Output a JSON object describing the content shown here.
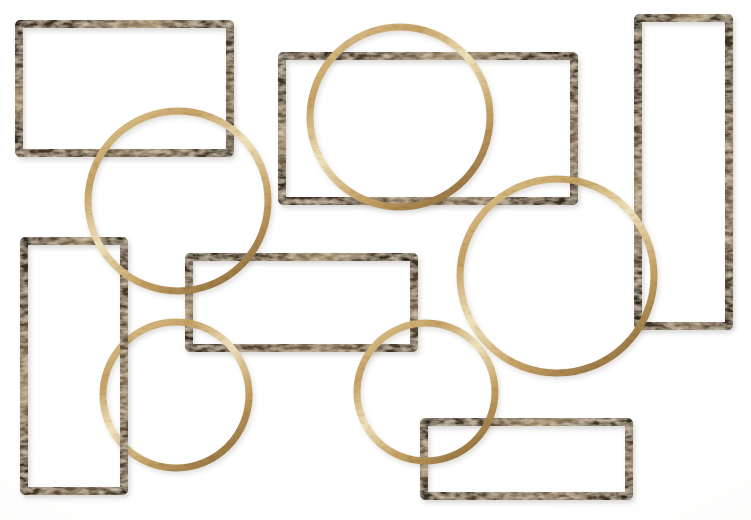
{
  "meta": {
    "description": "Decorative metal wall art: interlocking distressed bronze open rectangles and antique gold rings on a white background"
  },
  "artwork": {
    "canvas": {
      "width": 751,
      "height": 520
    },
    "background": "#ffffff",
    "materials": {
      "bronze": {
        "base": "#4e3d2b",
        "dark": "#2e241a",
        "light": "#7b654a",
        "highlight": "#9c8766",
        "speckle": "#b39973"
      },
      "gold": {
        "base": "#c4a165",
        "dark": "#9a7945",
        "light": "#e4cf9d",
        "highlight": "#f0e2bc",
        "speckle": "#8a6c3b"
      }
    },
    "shadow": {
      "dx": 2,
      "dy": 3,
      "blur": 2.5,
      "color": "#555044",
      "opacity": 0.22
    },
    "shapes": [
      {
        "id": "rectangle-middle",
        "type": "rect",
        "material": "bronze",
        "x": 189,
        "y": 257,
        "width": 225,
        "height": 91,
        "stroke_width": 8
      },
      {
        "id": "circle-bottom-left",
        "type": "circle",
        "material": "gold",
        "cx": 176,
        "cy": 395,
        "r": 73,
        "stroke_width": 7
      },
      {
        "id": "rectangle-left-tall",
        "type": "rect",
        "material": "bronze",
        "x": 24,
        "y": 241,
        "width": 100,
        "height": 250,
        "stroke_width": 8
      },
      {
        "id": "rectangle-top-middle",
        "type": "rect",
        "material": "bronze",
        "x": 282,
        "y": 56,
        "width": 292,
        "height": 145,
        "stroke_width": 8
      },
      {
        "id": "rectangle-right-tall",
        "type": "rect",
        "material": "bronze",
        "x": 638,
        "y": 18,
        "width": 91,
        "height": 308,
        "stroke_width": 8
      },
      {
        "id": "rectangle-bottom-right",
        "type": "rect",
        "material": "bronze",
        "x": 424,
        "y": 422,
        "width": 205,
        "height": 74,
        "stroke_width": 8
      },
      {
        "id": "rectangle-top-left",
        "type": "rect",
        "material": "bronze",
        "x": 19,
        "y": 24,
        "width": 211,
        "height": 129,
        "stroke_width": 8
      },
      {
        "id": "circle-upper-left",
        "type": "circle",
        "material": "gold",
        "cx": 178,
        "cy": 201,
        "r": 90,
        "stroke_width": 7
      },
      {
        "id": "circle-top-middle",
        "type": "circle",
        "material": "gold",
        "cx": 400,
        "cy": 117,
        "r": 90,
        "stroke_width": 7
      },
      {
        "id": "circle-right-large",
        "type": "circle",
        "material": "gold",
        "cx": 557,
        "cy": 276,
        "r": 97,
        "stroke_width": 7
      },
      {
        "id": "circle-bottom-middle",
        "type": "circle",
        "material": "gold",
        "cx": 426,
        "cy": 392,
        "r": 69,
        "stroke_width": 7
      }
    ]
  }
}
